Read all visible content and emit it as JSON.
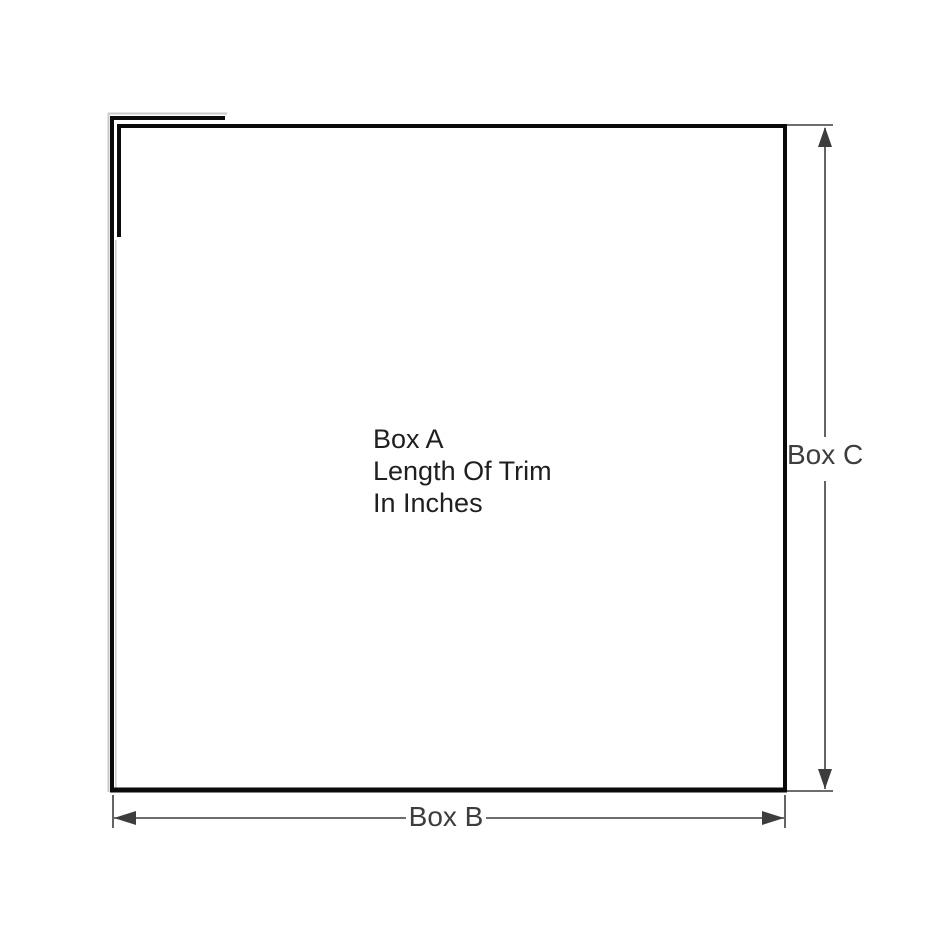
{
  "diagram": {
    "description": "Trim measurement diagram",
    "colors": {
      "box_line": "#0a0a0a",
      "dimension": "#3d3d3d",
      "label_a": "#1f1f1f",
      "shadow": "#c9c9c9",
      "background": "#ffffff"
    },
    "labels": {
      "box_a": {
        "line1": "Box A",
        "line2": "Length Of Trim",
        "line3": "In Inches"
      },
      "box_b": "Box B",
      "box_c": "Box C"
    }
  }
}
